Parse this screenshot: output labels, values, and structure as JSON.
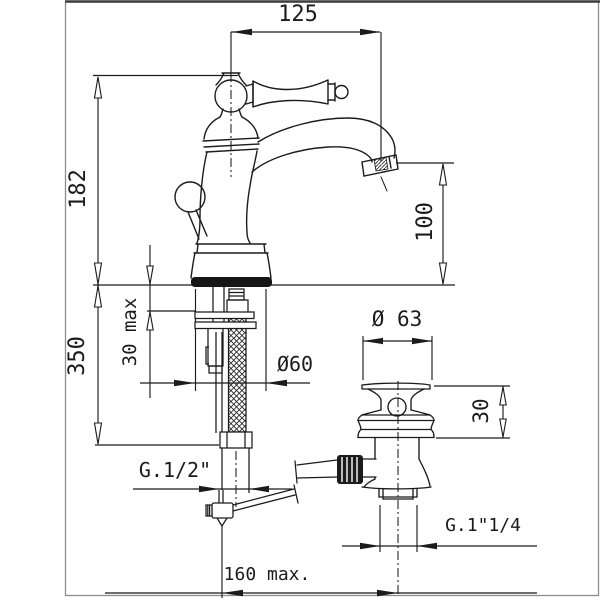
{
  "drawing": {
    "type": "technical-dimension-drawing",
    "subject": "single-lever basin mixer tap with pop-up waste",
    "colors": {
      "line": "#1b1b1b",
      "frame": "#8d8d8d",
      "background": "#ffffff"
    },
    "dimensions": {
      "spout_reach": "125",
      "total_height": "182",
      "spout_height": "100",
      "hose_length": "350",
      "deck_thickness_max": "30 max",
      "base_diameter": "Ø60",
      "waste_flange_diameter": "Ø 63",
      "waste_flange_height": "30",
      "inlet_thread": "G.1/2\"",
      "waste_thread": "G.1\"1/4",
      "rod_reach_max": "160 max."
    }
  }
}
